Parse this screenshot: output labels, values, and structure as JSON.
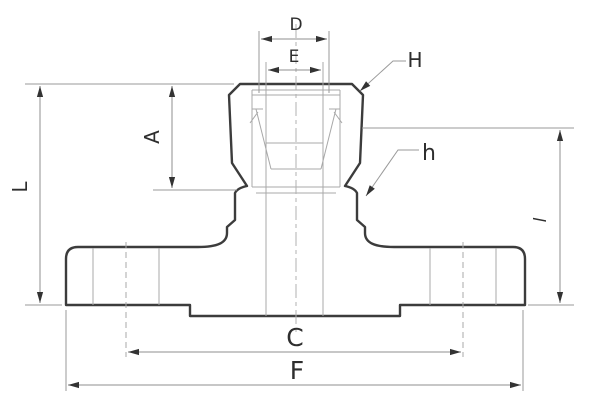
{
  "figure": {
    "kind": "technical-dimension-drawing",
    "subject": "flanged compression tube fitting cross-section"
  },
  "labels": {
    "D": "D",
    "E": "E",
    "H": "H",
    "h": "h",
    "A": "A",
    "L": "L",
    "l": "l",
    "C": "C",
    "F": "F"
  },
  "colors": {
    "background": "#ffffff",
    "outline": "#3c3c3c",
    "thin_line": "#a8a8a8",
    "dimension_line": "#8f8f8f",
    "arrow": "#333333",
    "text": "#2e2e2e"
  }
}
